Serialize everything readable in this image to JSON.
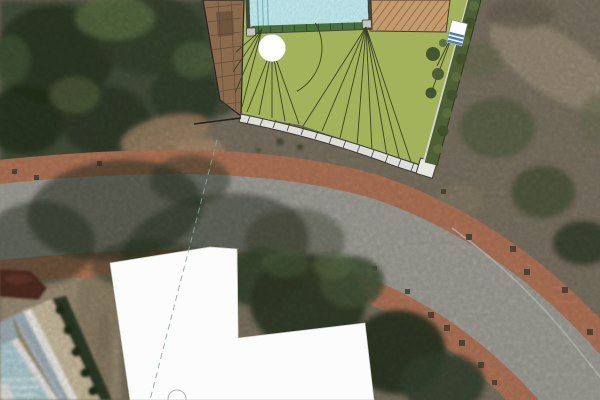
{
  "meta": {
    "title": "aerial-site-plan-view",
    "description": "Satellite aerial photograph with a landscape architecture site-plan overlay: lawn with grading lines, swimming pool, wood deck, neighbor roof, retaining wall, hedge row, curved street with brick sidewalks, and a white L-shaped building footprint overlay.",
    "image": {
      "width": 600,
      "height": 400
    }
  },
  "colors": {
    "lawn": "#a3b35c",
    "plan_line": "#3a4224",
    "pool_water": "#9ed3d8",
    "pool_border": "#42453c",
    "pool_edge_green": "#47703c",
    "deck_wood": "#8a6b4d",
    "neighbor_roof": "#c49b6e",
    "roof_hatch": "#8a6647",
    "retaining_wall": "#dededa",
    "wall_outline": "#3c3c34",
    "hedge_green": "#4e5e35",
    "stairs_blue": "#4f7fb0",
    "sidewalk_brick": "#b5785a",
    "asphalt": "#a3a29a",
    "road_gutter": "#c2c2bb",
    "forest_mid": "#45513a",
    "scrub": "#7d7463",
    "dirt": "#9d8f76",
    "shadow": "#27311f",
    "overlay_white": "#fcfcfc",
    "dashed_line": "#86a89a",
    "tree_symbol_white": "#ffffff",
    "maroon_roof": "#512d24",
    "lap_pool": "#b3d1d6",
    "building_roof_gray": "#a4b3bb",
    "terrace_beige": "#cdbfa2",
    "hedge_dark": "#2f3c26",
    "dot_marker": "#4a4438"
  },
  "scene": {
    "base_layer": "satellite photo",
    "plan_elements": [
      "lawn",
      "swimming-pool",
      "wood-deck",
      "neighbor-roof",
      "retaining-wall",
      "hedge-row",
      "garden-stairs",
      "tree-symbol",
      "grading-lines"
    ],
    "road": [
      "asphalt street",
      "brick sidewalk upper",
      "brick sidewalk lower",
      "curb gutter",
      "drain markers",
      "tree shadows"
    ],
    "overlays": [
      "white L-shaped building footprint",
      "dashed setback line",
      "small tree circle at bottom edge"
    ]
  }
}
